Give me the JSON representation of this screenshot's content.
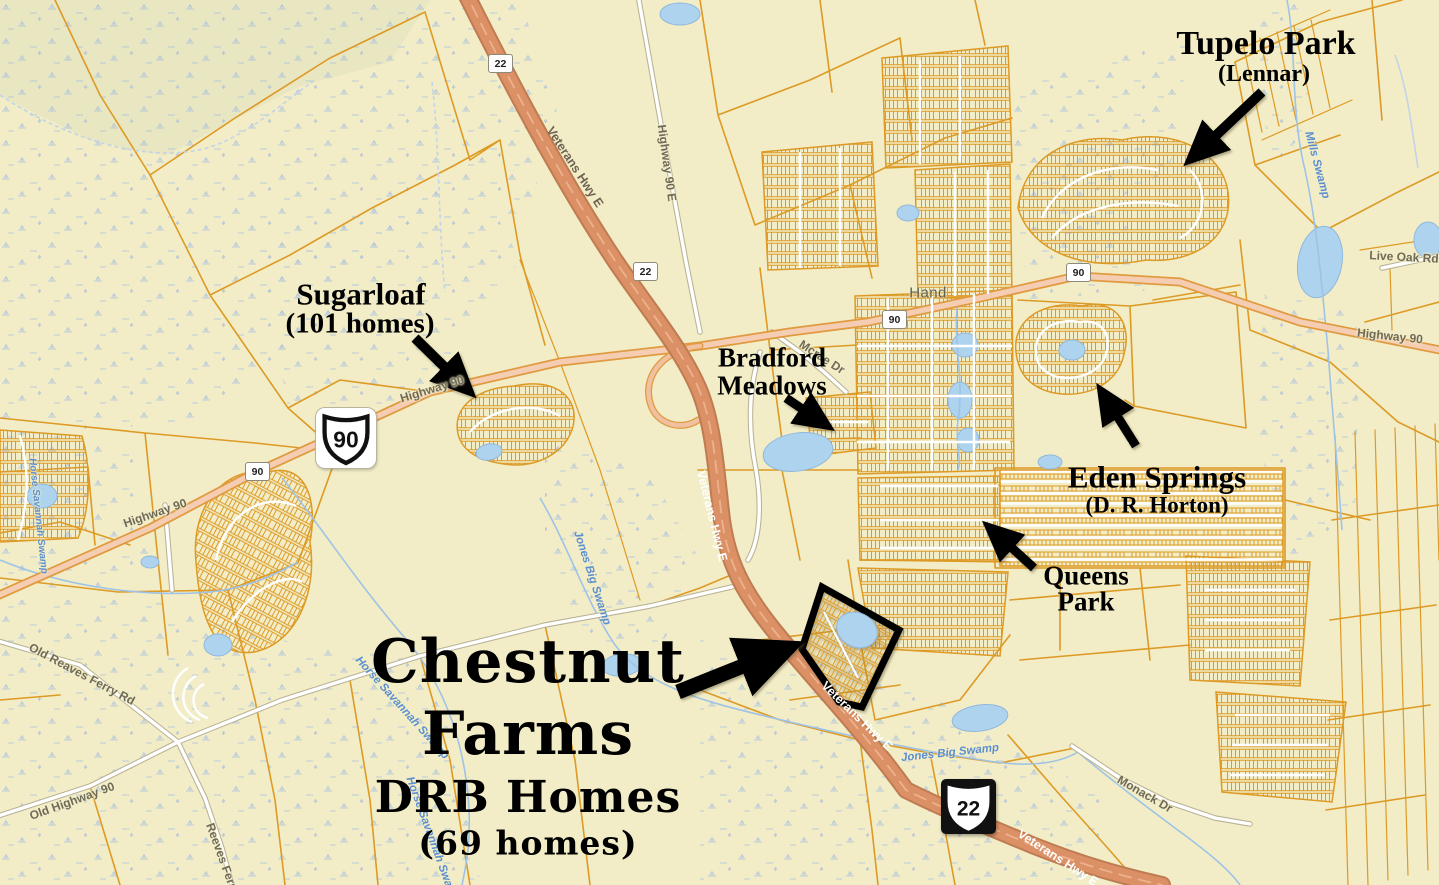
{
  "title": "Chestnut Farms new-home communities map",
  "palette": {
    "background": "#f2edc7",
    "parcel_line": "#dd9a25",
    "freeway_fill": "#db9065",
    "freeway_edge": "#bf7b52",
    "highway_fill": "#f5cdb2",
    "highway_edge": "#e09a40",
    "local_road": "#ffffff",
    "pond": "#aed3ee",
    "stream": "#9ec3e6",
    "annotation": "#000000",
    "street_label": "#6f6a58",
    "water_label": "#5b8fd0"
  },
  "annotations": {
    "tupelo_park": {
      "line1": "Tupelo Park",
      "line2": "(Lennar)"
    },
    "sugarloaf": {
      "line1": "Sugarloaf",
      "line2": "(101 homes)"
    },
    "bradford_meadows": {
      "line1": "Bradford",
      "line2": "Meadows"
    },
    "eden_springs": {
      "line1": "Eden Springs",
      "line2": "(D. R. Horton)"
    },
    "queens_park": {
      "line1": "Queens",
      "line2": "Park"
    },
    "chestnut_farms": {
      "line1": "Chestnut",
      "line2": "Farms",
      "line3": "DRB Homes",
      "line4": "(69 homes)"
    }
  },
  "route_shields": {
    "us90_large": "90",
    "us22_large": "22",
    "sc22_small_top": "22",
    "sc22_small_mid": "22",
    "sc90_small_left": "90",
    "sc90_small_hand_west": "90",
    "sc90_small_hand_east": "90"
  },
  "place_labels": {
    "hand": "Hand"
  },
  "street_labels": [
    {
      "text": "Highway 90"
    },
    {
      "text": "Highway 90"
    },
    {
      "text": "Highway 90"
    },
    {
      "text": "Highway 90 E"
    },
    {
      "text": "Veterans Hwy E"
    },
    {
      "text": "Veterans Hwy E"
    },
    {
      "text": "Veterans Hwy E"
    },
    {
      "text": "Veterans Hwy E"
    },
    {
      "text": "Old Reaves Ferry Rd"
    },
    {
      "text": "Old Highway 90"
    },
    {
      "text": "Reeves Ferry Rd"
    },
    {
      "text": "Monack Dr"
    },
    {
      "text": "Live Oak Rd"
    },
    {
      "text": "Mcrae Dr"
    }
  ],
  "water_labels": [
    {
      "text": "Mills Swamp"
    },
    {
      "text": "Jones Big Swamp"
    },
    {
      "text": "Jones Big Swamp"
    },
    {
      "text": "Horse Savannah Swamp"
    },
    {
      "text": "Horse Savannah Swamp"
    },
    {
      "text": "Horse Savannah Swamp"
    }
  ]
}
